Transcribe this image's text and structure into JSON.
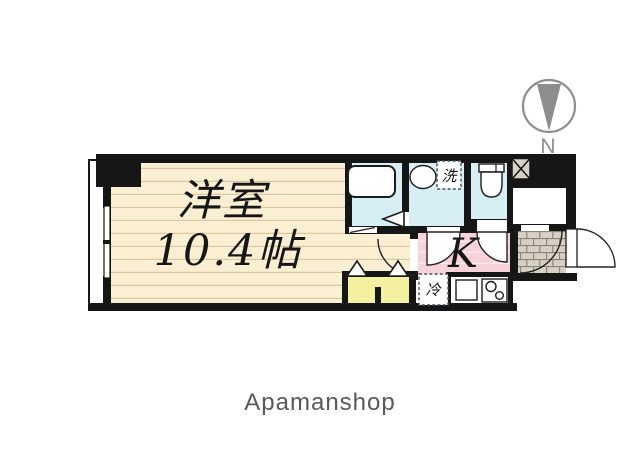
{
  "plan": {
    "room_label": "洋室",
    "room_size": "10.4帖",
    "kitchen_label": "K",
    "laundry_label": "洗",
    "fridge_label": "冷"
  },
  "compass": {
    "north_label": "N"
  },
  "footer": {
    "brand": "Apamanshop"
  },
  "colors": {
    "wall": "#161616",
    "room_floor": "#faefd2",
    "floor_line": "#d9c7a0",
    "wet_area": "#d7eef5",
    "kitchen": "#f7d2d8",
    "closet_yellow": "#f3f0a0",
    "entry_tile": "#d6d1c4",
    "compass_gray": "#8d8d8d"
  }
}
